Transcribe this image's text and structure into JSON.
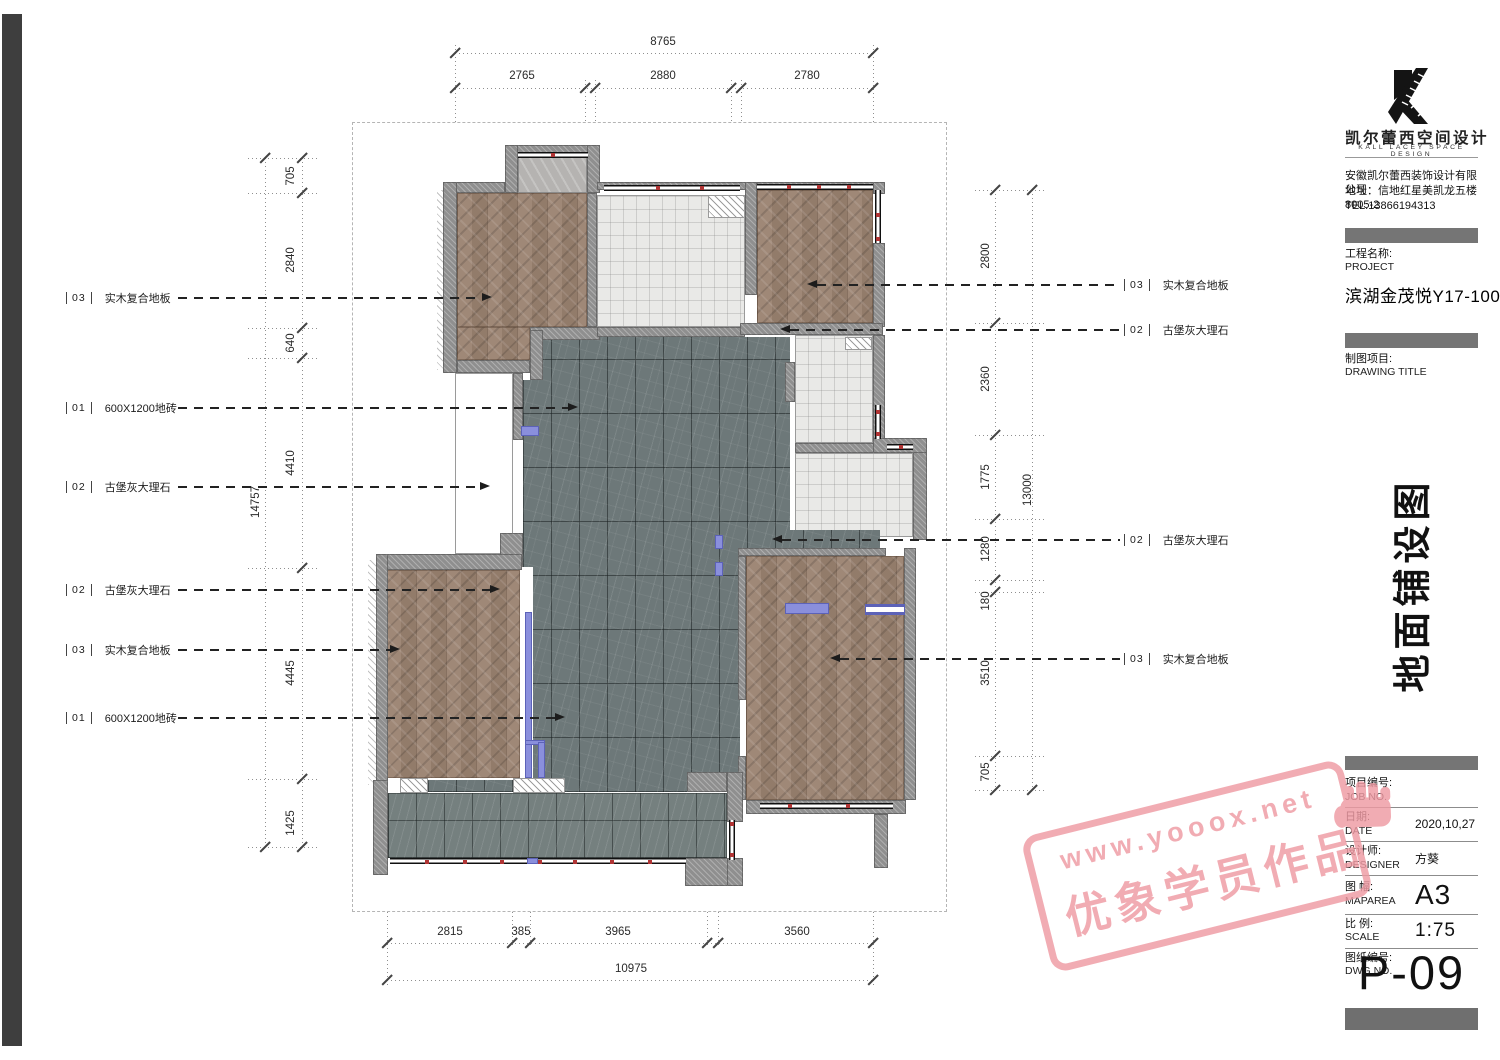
{
  "colors": {
    "wood": "#9a8270",
    "marble": "#6d7879",
    "tile": "#e9e9e7",
    "entry_tile": "#b5b3b1",
    "wall": "#8f8f8f",
    "accent": "#8a8fdc",
    "stamp": "#ef9aa3",
    "wdot": "#b03434",
    "leader": "#222222"
  },
  "plan": {
    "dims": {
      "top": {
        "overall": "8765",
        "s1": "2765",
        "s2": "2880",
        "s3": "2780"
      },
      "bottom": {
        "overall": "10975",
        "s1": "2815",
        "s2": "385",
        "s3": "3965",
        "s4": "3560"
      },
      "left": {
        "overall": "14757",
        "s1": "705",
        "s2": "2840",
        "s3": "640",
        "s4": "4410",
        "s5": "4445",
        "s6": "1425"
      },
      "right": {
        "overall": "13000",
        "s1": "2800",
        "s2": "2360",
        "s3": "1775",
        "s4": "1280",
        "s5": "180",
        "s6": "3510",
        "s7": "705"
      }
    },
    "labels_left": [
      {
        "code": "03",
        "text": "实木复合地板"
      },
      {
        "code": "01",
        "text": "600X1200地砖"
      },
      {
        "code": "02",
        "text": "古堡灰大理石"
      },
      {
        "code": "02",
        "text": "古堡灰大理石"
      },
      {
        "code": "03",
        "text": "实木复合地板"
      },
      {
        "code": "01",
        "text": "600X1200地砖"
      }
    ],
    "labels_right": [
      {
        "code": "03",
        "text": "实木复合地板"
      },
      {
        "code": "02",
        "text": "古堡灰大理石"
      },
      {
        "code": "02",
        "text": "古堡灰大理石"
      },
      {
        "code": "03",
        "text": "实木复合地板"
      }
    ]
  },
  "titleblock": {
    "logo_cn": "凯尔蕾西空间设计",
    "logo_en": "KALL LACEY SPACE DESIGN",
    "company": "安徽凯尔蕾西装饰设计有限公司",
    "address": "地址：信地红星美凯龙五楼8005-2",
    "tel": "TEL:13866194313",
    "project_label": "工程名称:",
    "project_en": "PROJECT",
    "project_name": "滨湖金茂悦Y17-1003室",
    "drawing_label": "制图项目:",
    "drawing_en": "DRAWING TITLE",
    "drawing_title": "地面铺设图",
    "rows": {
      "job": {
        "label": "项目编号:",
        "en": "JOB NO.",
        "value": ""
      },
      "date": {
        "label": "日期:",
        "en": "DATE",
        "value": "2020,10,27"
      },
      "designer": {
        "label": "设计师:",
        "en": "DESIGNER",
        "value": "方葵"
      },
      "maparea": {
        "label": "图 幅:",
        "en": "MAPAREA",
        "value": "A3"
      },
      "scale": {
        "label": "比 例:",
        "en": "SCALE",
        "value": "1:75"
      },
      "dwg": {
        "label": "图纸编号:",
        "en": "DWG NO.",
        "value": "P-09"
      }
    }
  },
  "watermark": {
    "line1": "www.yooox.net",
    "line2": "优象学员作品"
  }
}
